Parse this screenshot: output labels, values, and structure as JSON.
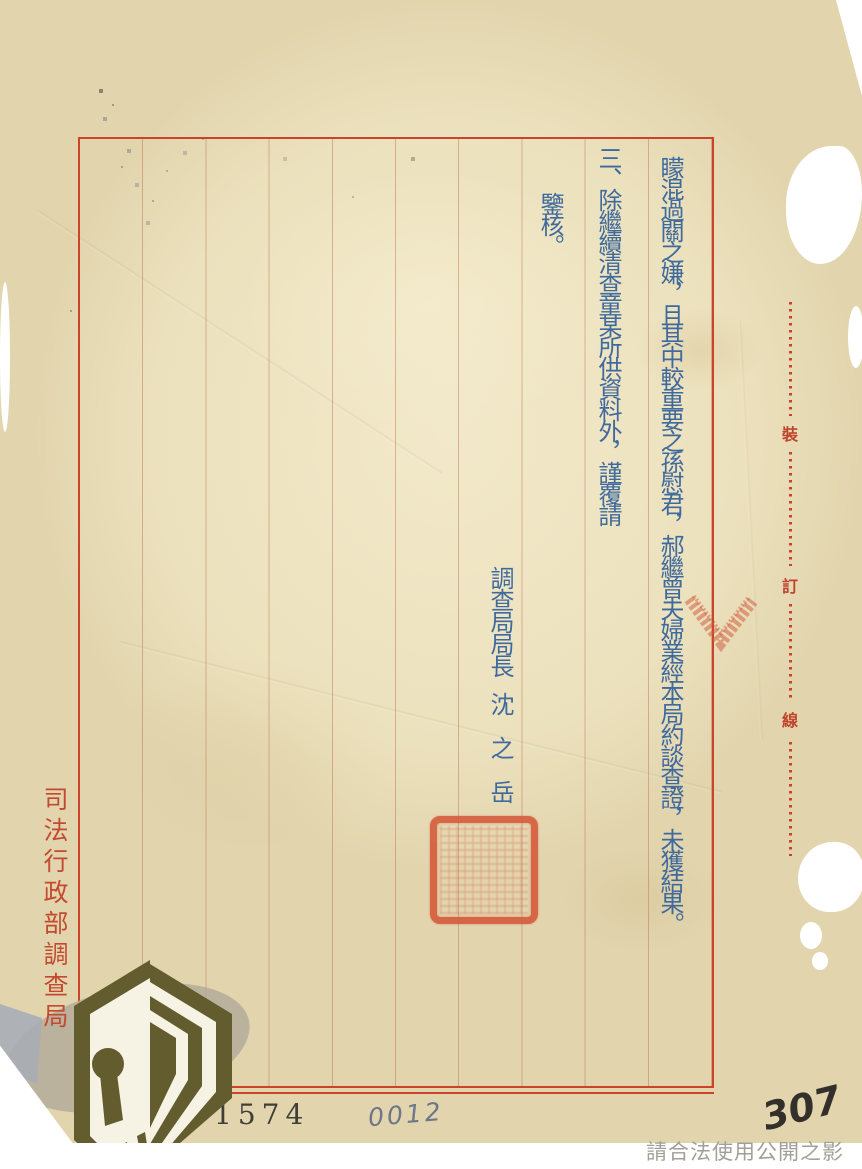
{
  "page": {
    "kind": "scanned-official-letter",
    "agency_margin_label": "司法行政部調查局",
    "binding_line": {
      "chars": [
        "裝",
        "訂",
        "線"
      ]
    },
    "body": {
      "columns": [
        "矇混過關之嫌，且其中較重要之孫慰君，郝繼曾夫婦業經本局約談查證，未獲結果。",
        "三、除繼續清查童某所供資料外，謹覆請",
        "鑒核。"
      ]
    },
    "signature": {
      "title": "調查局局長",
      "name": "沈　之　岳"
    },
    "stamps": {
      "page_number": "1574"
    },
    "handwritten": {
      "folio_left": "0012",
      "folio_right": "307"
    },
    "watermark": "請合法使用公開之影像",
    "colors": {
      "paper": "#ece1bd",
      "frame_red": "#cb4429",
      "ink_blue": "#3f6a9e",
      "margin_red": "#c34a30",
      "seal_red": "#d0543a"
    }
  }
}
